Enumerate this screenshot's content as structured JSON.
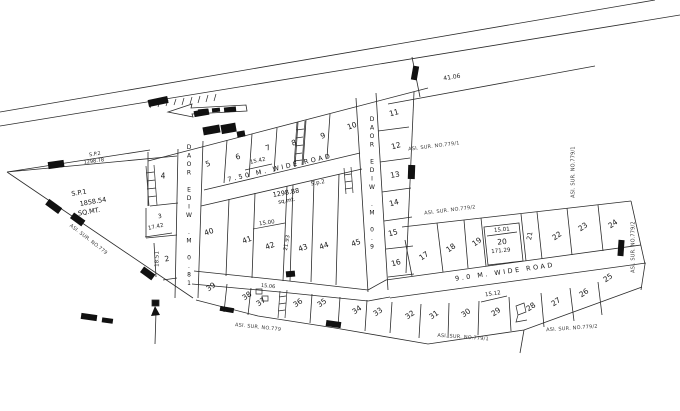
{
  "roads": {
    "wide_750": "7.50 M. WIDE ROAD",
    "wide_900": "9.0 M. WIDE ROAD",
    "wide_900_vertical": "9.0 M. WIDE ROAD",
    "wide_180_vertical": "18.0 M. WIDE ROAD"
  },
  "parcels": {
    "sp1": {
      "name": "S.P.1",
      "area": "1858.54",
      "unit": "SQ.MT."
    },
    "sp2": {
      "name": "S.p.2",
      "area": "1298.88",
      "unit": "sq.mt."
    },
    "sp2_boundary": {
      "name": "S.P.2",
      "value": "1298.78"
    }
  },
  "survey_numbers": {
    "no779": "ASI. SUR. NO.779",
    "no779_1": "ASI. SUR. NO.779/1",
    "no779_2": "ASI. SUR. NO.779/2"
  },
  "dimensions": {
    "boundary_top_right": "41.06",
    "plot7_width": "15.42",
    "plot3_width": "17.42",
    "plot2_depth": "18.51",
    "plot42_width": "15.00",
    "plot42_depth": "21.93",
    "plot20_width": "15.01",
    "plot20_area": "171.29",
    "plot29_width": "15.12",
    "plot37_width": "15.06"
  },
  "plots": {
    "p2": "2",
    "p3": "3",
    "p4": "4",
    "p5": "5",
    "p6": "6",
    "p7": "7",
    "p8": "8",
    "p9": "9",
    "p10": "10",
    "p11": "11",
    "p12": "12",
    "p13": "13",
    "p14": "14",
    "p15": "15",
    "p16": "16",
    "p17": "17",
    "p18": "18",
    "p19": "19",
    "p20": "20",
    "p21": "21",
    "p22": "22",
    "p23": "23",
    "p24": "24",
    "p25": "25",
    "p26": "26",
    "p27": "27",
    "p28": "28",
    "p29": "29",
    "p30": "30",
    "p31": "31",
    "p32": "32",
    "p33": "33",
    "p34": "34",
    "p35": "35",
    "p36": "36",
    "p37": "37",
    "p38": "38",
    "p39": "39",
    "p40": "40",
    "p41": "41",
    "p42": "42",
    "p43": "43",
    "p44": "44",
    "p45": "45"
  }
}
